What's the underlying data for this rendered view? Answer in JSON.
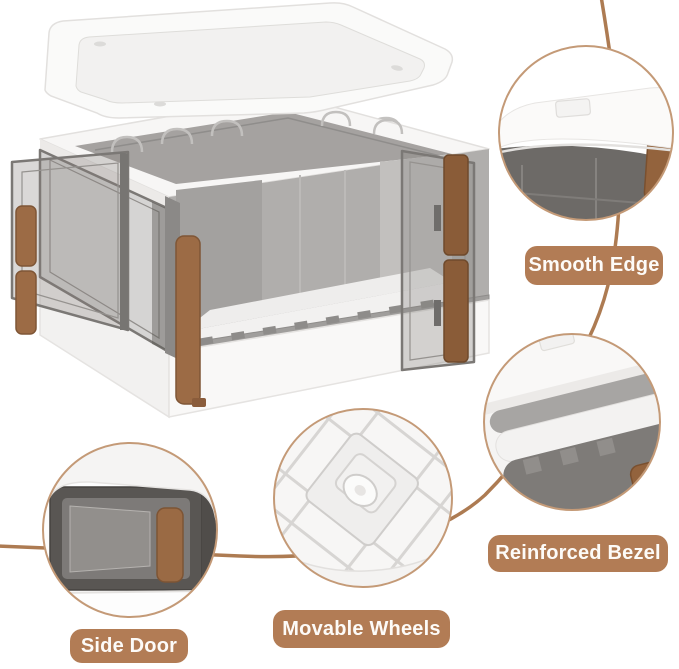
{
  "image": {
    "type": "product-feature-annotation",
    "product": "foldable storage box with lid, side doors and wheels",
    "background": "#ffffff",
    "accent_brown": "#b27c55",
    "arc_color": "#ad7b52",
    "ring_color": "#c49a77",
    "label_text_color": "#fdfbf8",
    "lid_white": "#fafaf9",
    "panel_smoke": "#7b7875",
    "handle_brown": "#9c6b45"
  },
  "callouts": [
    {
      "id": "smooth-edge",
      "label": "Smooth Edge"
    },
    {
      "id": "reinforced-bezel",
      "label": "Reinforced Bezel"
    },
    {
      "id": "movable-wheels",
      "label": "Movable Wheels"
    },
    {
      "id": "side-door",
      "label": "Side Door"
    }
  ]
}
